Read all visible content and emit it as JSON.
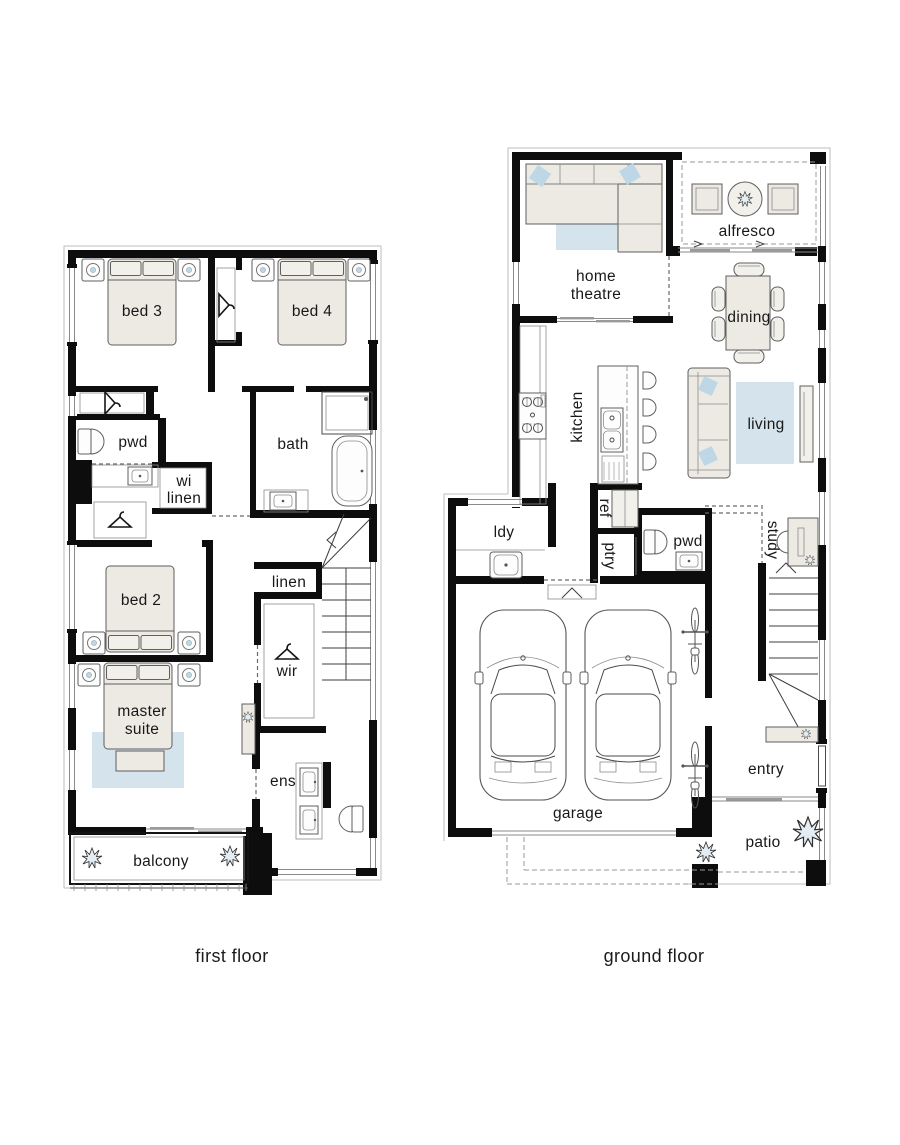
{
  "page": {
    "background": "#ffffff",
    "type": "architectural floor plan, two storeys"
  },
  "floors": {
    "first": {
      "caption": "first floor",
      "rooms": {
        "bed3": "bed 3",
        "bed4": "bed 4",
        "pwd": "pwd",
        "wi_linen": [
          "wi",
          "linen"
        ],
        "bath": "bath",
        "bed2": "bed 2",
        "linen": "linen",
        "wir": "wir",
        "master": [
          "master",
          "suite"
        ],
        "ens": "ens",
        "balcony": "balcony"
      }
    },
    "ground": {
      "caption": "ground floor",
      "rooms": {
        "home_theatre": [
          "home",
          "theatre"
        ],
        "alfresco": "alfresco",
        "dining": "dining",
        "living": "living",
        "kitchen": "kitchen",
        "ref": "ref",
        "ptry": "ptry",
        "ldy": "ldy",
        "pwd": "pwd",
        "study": "study",
        "garage": "garage",
        "entry": "entry",
        "patio": "patio"
      }
    }
  },
  "icons": {
    "plant-icon": "starburst shrub",
    "hanger-icon": "clothes hanger",
    "bed-icon": "double bed with pillows",
    "lamp-icon": "bedside lamp circle",
    "toilet-icon": "toilet",
    "sink-icon": "basin",
    "bathtub-icon": "freestanding bath",
    "shower-icon": "shower",
    "sofa-icon": "sofa",
    "car-icon": "car top view",
    "bike-icon": "bicycle top view",
    "stairs": "stair run with winders"
  },
  "colors": {
    "wall": "#0d0d0d",
    "furniture_fill": "#EDEAE3",
    "furniture_fill_light": "#F2F0EA",
    "furniture_stroke": "#5f5f5f",
    "rug_fill": "#D5E3ED",
    "rug_stroke": "#9FB9C9",
    "cushion_fill": "#BDD7E7",
    "plant_fill": "#E3EDF3",
    "window_line": "#8a8a8a",
    "outline": "#bdbdbd",
    "text": "#181818"
  }
}
